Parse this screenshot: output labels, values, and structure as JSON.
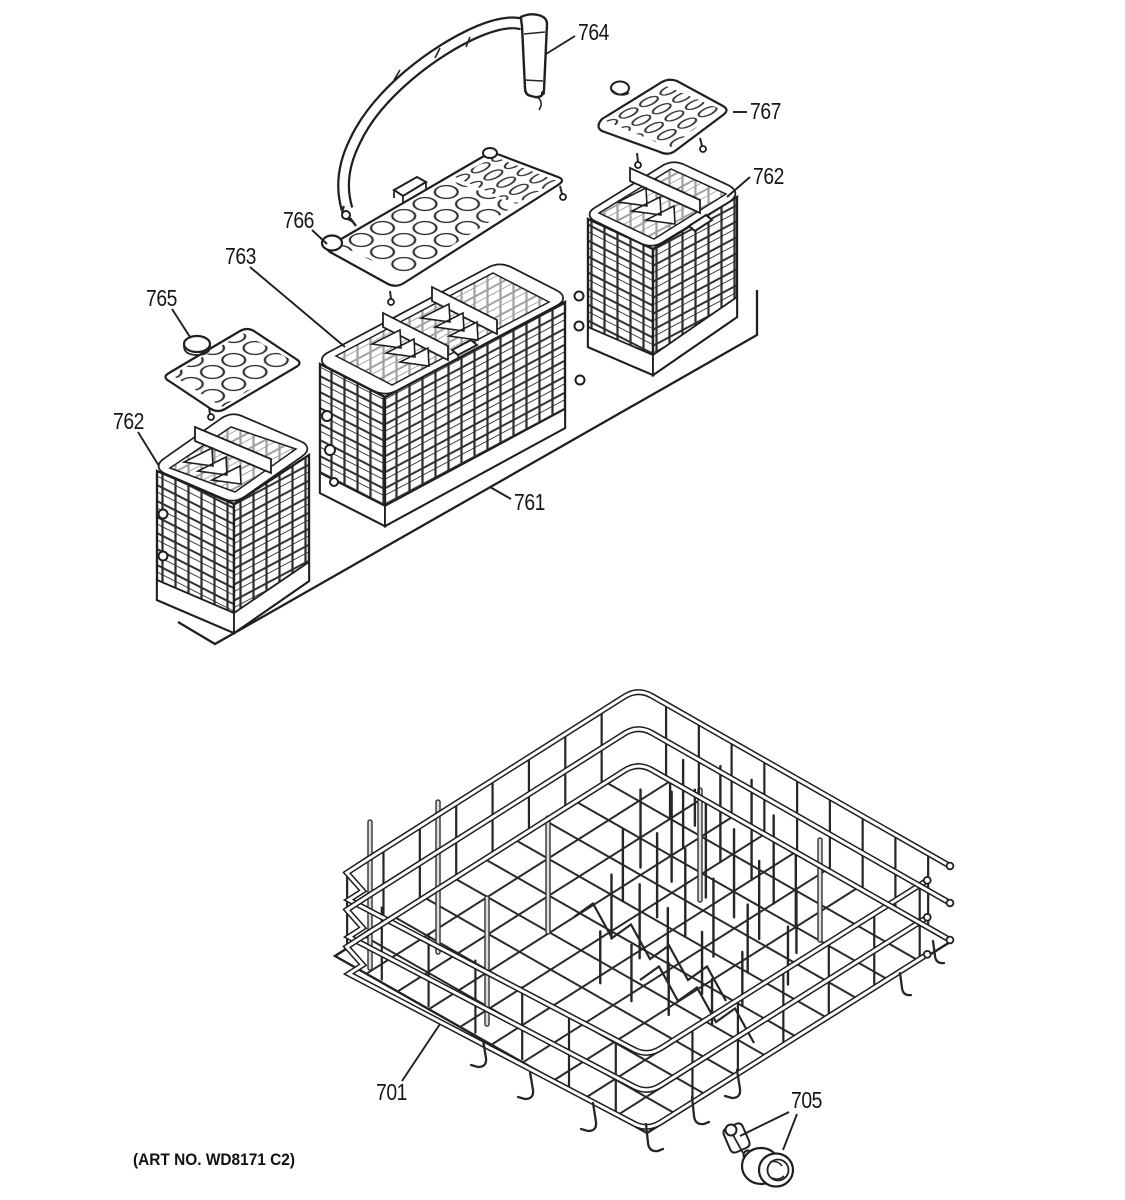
{
  "figure": {
    "background_color": "#ffffff",
    "line_color": "#1f1f1f",
    "art_number": "(ART NO. WD8171 C2)",
    "callouts": {
      "handle": {
        "label": "764"
      },
      "cover_right": {
        "label": "767"
      },
      "basket_right": {
        "label": "762"
      },
      "cover_center": {
        "label": "766"
      },
      "center_basket": {
        "label": "763"
      },
      "cover_left": {
        "label": "765"
      },
      "basket_left": {
        "label": "762"
      },
      "assembly": {
        "label": "761"
      },
      "lower_rack": {
        "label": "701"
      },
      "roller": {
        "label": "705"
      }
    }
  }
}
